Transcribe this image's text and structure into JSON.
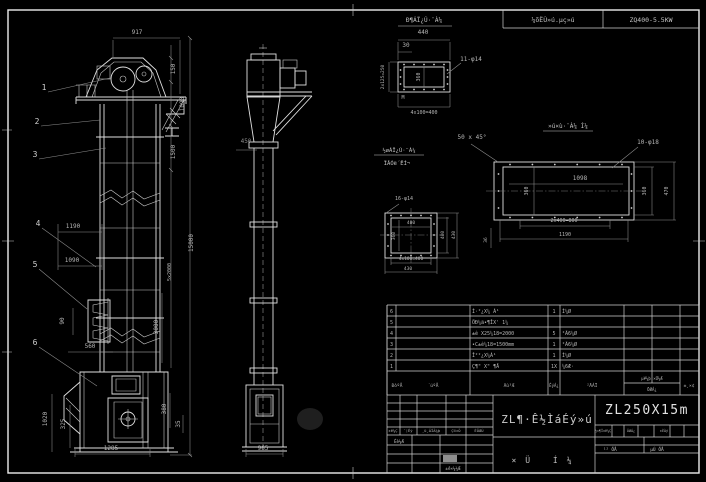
{
  "sheet": {
    "header": {
      "mid_cell": "¼õËÙ»ú.µç»ú",
      "right_cell": "ZQ400-5.5KW"
    },
    "details": {
      "d1_title": "Ð¶ÁÏ¿Ú·¨À¼",
      "d2_title": "»ú×ù·¨À¼ Í¼",
      "d3_title_1": "½øÁÏ¿Ú·¨À¼",
      "d3_title_2": "ÏÂÓë´ËÍ¬"
    },
    "titleblock": {
      "model": "ZL250X15m",
      "title": "ZL¶·Ê½ÌáÉý»ú",
      "subtitle": "×Ü Í¼",
      "rev_labels": [
        "±ê¼Ç",
        "´¦Êý",
        "¸ü¸ÄÎÄ¼þ",
        "Ç©×Ö",
        "ÈÕÆÚ"
      ],
      "sign_label_1": "Éè¼Æ",
      "sign_label_2": "±ê×¼¼Æ",
      "right_labels": [
        "½×¶Î±ê¼Ç",
        "ÖØÁ¿",
        "±ÈÀý"
      ],
      "sheet_label_1": "¹² ÕÅ",
      "sheet_label_2": "µÚ ÕÅ"
    }
  },
  "balloons": [
    {
      "n": "1",
      "x": 44,
      "y": 90,
      "lx": 110,
      "ly": 78
    },
    {
      "n": "2",
      "x": 37,
      "y": 124,
      "lx": 100,
      "ly": 120
    },
    {
      "n": "3",
      "x": 35,
      "y": 157,
      "lx": 106,
      "ly": 148
    },
    {
      "n": "4",
      "x": 38,
      "y": 226,
      "lx": 96,
      "ly": 267
    },
    {
      "n": "5",
      "x": 35,
      "y": 267,
      "lx": 87,
      "ly": 309
    },
    {
      "n": "6",
      "x": 35,
      "y": 345,
      "lx": 97,
      "ly": 386
    }
  ],
  "dims": [
    {
      "t": "917",
      "x": 137,
      "y": 34
    },
    {
      "t": "150",
      "x": 175,
      "y": 69,
      "r": 1
    },
    {
      "t": "1090",
      "x": 184,
      "y": 104,
      "r": 1
    },
    {
      "t": "1500",
      "x": 175,
      "y": 152,
      "r": 1
    },
    {
      "t": "15000",
      "x": 193,
      "y": 243,
      "r": 1
    },
    {
      "t": "5x2000",
      "x": 171,
      "y": 272,
      "r": 1,
      "s": 5
    },
    {
      "t": "1190",
      "x": 73,
      "y": 228
    },
    {
      "t": "1090",
      "x": 72,
      "y": 262
    },
    {
      "t": "90",
      "x": 64,
      "y": 321,
      "r": 1
    },
    {
      "t": "560",
      "x": 90,
      "y": 348
    },
    {
      "t": "3000",
      "x": 158,
      "y": 327,
      "r": 1
    },
    {
      "t": "1020",
      "x": 47,
      "y": 419,
      "r": 1
    },
    {
      "t": "325",
      "x": 65,
      "y": 424,
      "r": 1
    },
    {
      "t": "380",
      "x": 166,
      "y": 409,
      "r": 1
    },
    {
      "t": "35",
      "x": 180,
      "y": 424,
      "r": 1
    },
    {
      "t": "1285",
      "x": 111,
      "y": 450
    },
    {
      "t": "450",
      "x": 246,
      "y": 143,
      "c": 1
    },
    {
      "t": "965",
      "x": 263,
      "y": 450
    },
    {
      "t": "440",
      "x": 423,
      "y": 34
    },
    {
      "t": "30",
      "x": 406,
      "y": 47
    },
    {
      "t": "2x125=250",
      "x": 384,
      "y": 77,
      "r": 1,
      "s": 4.5
    },
    {
      "t": "360",
      "x": 420,
      "y": 77,
      "r": 1,
      "s": 5
    },
    {
      "t": "11-φ14",
      "x": 471,
      "y": 61
    },
    {
      "t": "M",
      "x": 403,
      "y": 99,
      "s": 5
    },
    {
      "t": "4x100=400",
      "x": 424,
      "y": 114,
      "s": 5
    },
    {
      "t": "50 x 45°",
      "x": 472,
      "y": 139
    },
    {
      "t": "10-φ18",
      "x": 648,
      "y": 144
    },
    {
      "t": "1098",
      "x": 580,
      "y": 180
    },
    {
      "t": "360",
      "x": 528,
      "y": 191,
      "r": 1,
      "s": 5
    },
    {
      "t": "360",
      "x": 646,
      "y": 191,
      "r": 1,
      "s": 5
    },
    {
      "t": "470",
      "x": 668,
      "y": 191,
      "r": 1,
      "s": 5
    },
    {
      "t": "2x400=800",
      "x": 564,
      "y": 222,
      "s": 5
    },
    {
      "t": "1190",
      "x": 565,
      "y": 236,
      "s": 5
    },
    {
      "t": "36",
      "x": 487,
      "y": 240,
      "r": 1,
      "s": 4.5
    },
    {
      "t": "16-φ14",
      "x": 404,
      "y": 200,
      "s": 5
    },
    {
      "t": "400",
      "x": 411,
      "y": 224,
      "s": 4.5
    },
    {
      "t": "360",
      "x": 395,
      "y": 236,
      "r": 1,
      "s": 4.5
    },
    {
      "t": "400",
      "x": 444,
      "y": 235,
      "r": 1,
      "s": 4.5
    },
    {
      "t": "430",
      "x": 455,
      "y": 235,
      "r": 1,
      "s": 4.5
    },
    {
      "t": "4x100=400",
      "x": 411,
      "y": 260,
      "s": 4.5
    },
    {
      "t": "430",
      "x": 408,
      "y": 270,
      "s": 4.5
    }
  ],
  "bom": {
    "headers": {
      "no": "ÐòºÅ",
      "code": "´úºÅ",
      "name": "Ãû³Æ",
      "qty": "ÊýÁ¿",
      "mat": "²ÄÁÏ",
      "weight_top": "µ¥¼þ ×Ü¼Æ",
      "weight_bottom": "ÖØÁ¿",
      "remark": "±¸×¢"
    },
    "rows": [
      {
        "no": "6",
        "code": "",
        "name": "Í·²¿X¼ Á¹",
        "qty": "1",
        "mat": "Ì¼Ø",
        "w1": "",
        "w2": "",
        "rk": ""
      },
      {
        "no": "5",
        "code": "",
        "name": "ÖÐ¼ä•¶ÎX' 1¼",
        "qty": "",
        "mat": "",
        "w1": "",
        "w2": "",
        "rk": ""
      },
      {
        "no": "4",
        "code": "",
        "name": "±ê X25¼18=2000",
        "qty": "5",
        "mat": "²Ã6¼Ø",
        "w1": "",
        "w2": "",
        "rk": ""
      },
      {
        "no": "3",
        "code": "",
        "name": "•C±ê¼18=1500mm",
        "qty": "1",
        "mat": "²Ã6¼Ø",
        "w1": "",
        "w2": "",
        "rk": ""
      },
      {
        "no": "2",
        "code": "",
        "name": "Î²²¿X¼Á¹",
        "qty": "1",
        "mat": "Ì¼Ø",
        "w1": "",
        "w2": "",
        "rk": ""
      },
      {
        "no": "1",
        "code": "",
        "name": "Ç¶\" X\" ¶Å",
        "qty": "1X",
        "mat": "¼6Æ·",
        "w1": "",
        "w2": "",
        "rk": ""
      }
    ]
  }
}
